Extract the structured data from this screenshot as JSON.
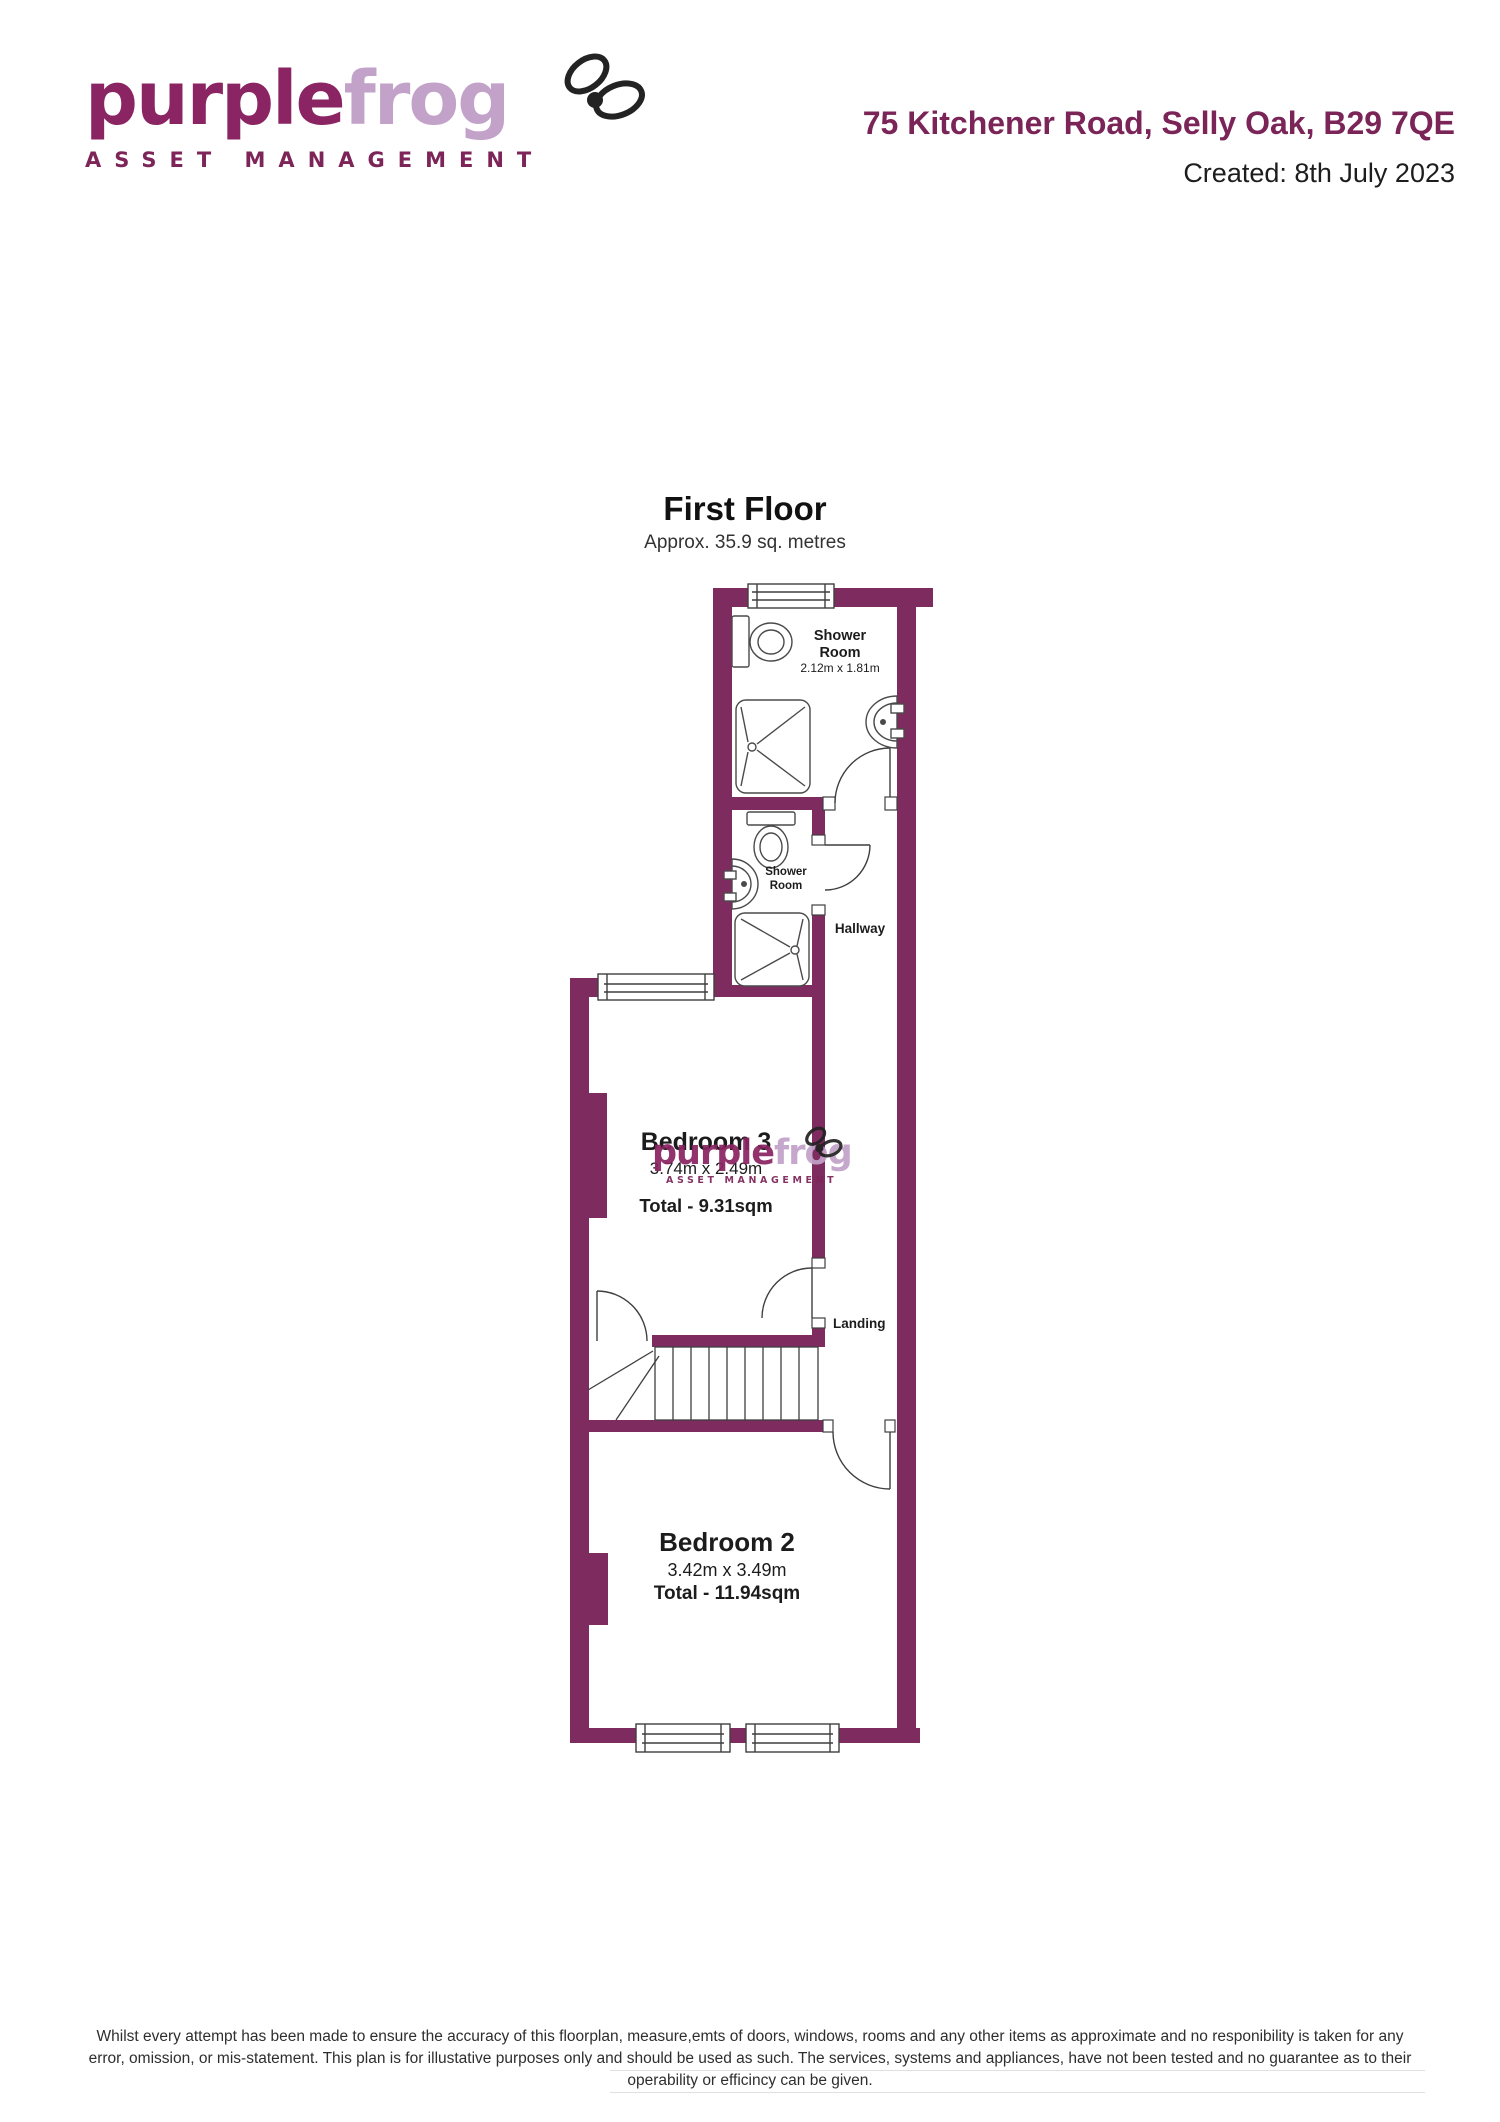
{
  "header": {
    "logo": {
      "word_purple": "purple",
      "word_frog": "frog",
      "tagline": "ASSET MANAGEMENT"
    },
    "address": "75 Kitchener Road, Selly Oak, B29 7QE",
    "created": "Created: 8th July 2023"
  },
  "floorplan": {
    "title": "First Floor",
    "subtitle": "Approx. 35.9 sq. metres",
    "labels": {
      "shower_room_top": {
        "line1": "Shower",
        "line2": "Room",
        "dims": "2.12m x 1.81m"
      },
      "shower_room_mid": {
        "line1": "Shower",
        "line2": "Room"
      },
      "hallway": "Hallway",
      "bedroom3": {
        "name": "Bedroom 3",
        "dims": "3.74m x 2.49m",
        "total": "Total - 9.31sqm"
      },
      "landing": "Landing",
      "bedroom2": {
        "name": "Bedroom 2",
        "dims": "3.42m x 3.49m",
        "total": "Total - 11.94sqm"
      }
    },
    "colors": {
      "wall": "#7e2b5f",
      "line": "#3f3f3f",
      "fixture_line": "#4a4a4a"
    }
  },
  "watermark": {
    "word_purple": "purple",
    "word_frog": "frog",
    "tagline": "ASSET MANAGEMENT"
  },
  "footer": {
    "line1": "Whilst every attempt has been made to ensure the accuracy of this floorplan, measure,emts of doors, windows, rooms and any other items as approximate and no responibility is taken for any",
    "line2": "error, omission, or mis-statement. This plan is for illustative purposes only and should be used as such. The services, systems and appliances, have not been tested and no guarantee as to their",
    "line3": "operability or efficincy can be given."
  }
}
